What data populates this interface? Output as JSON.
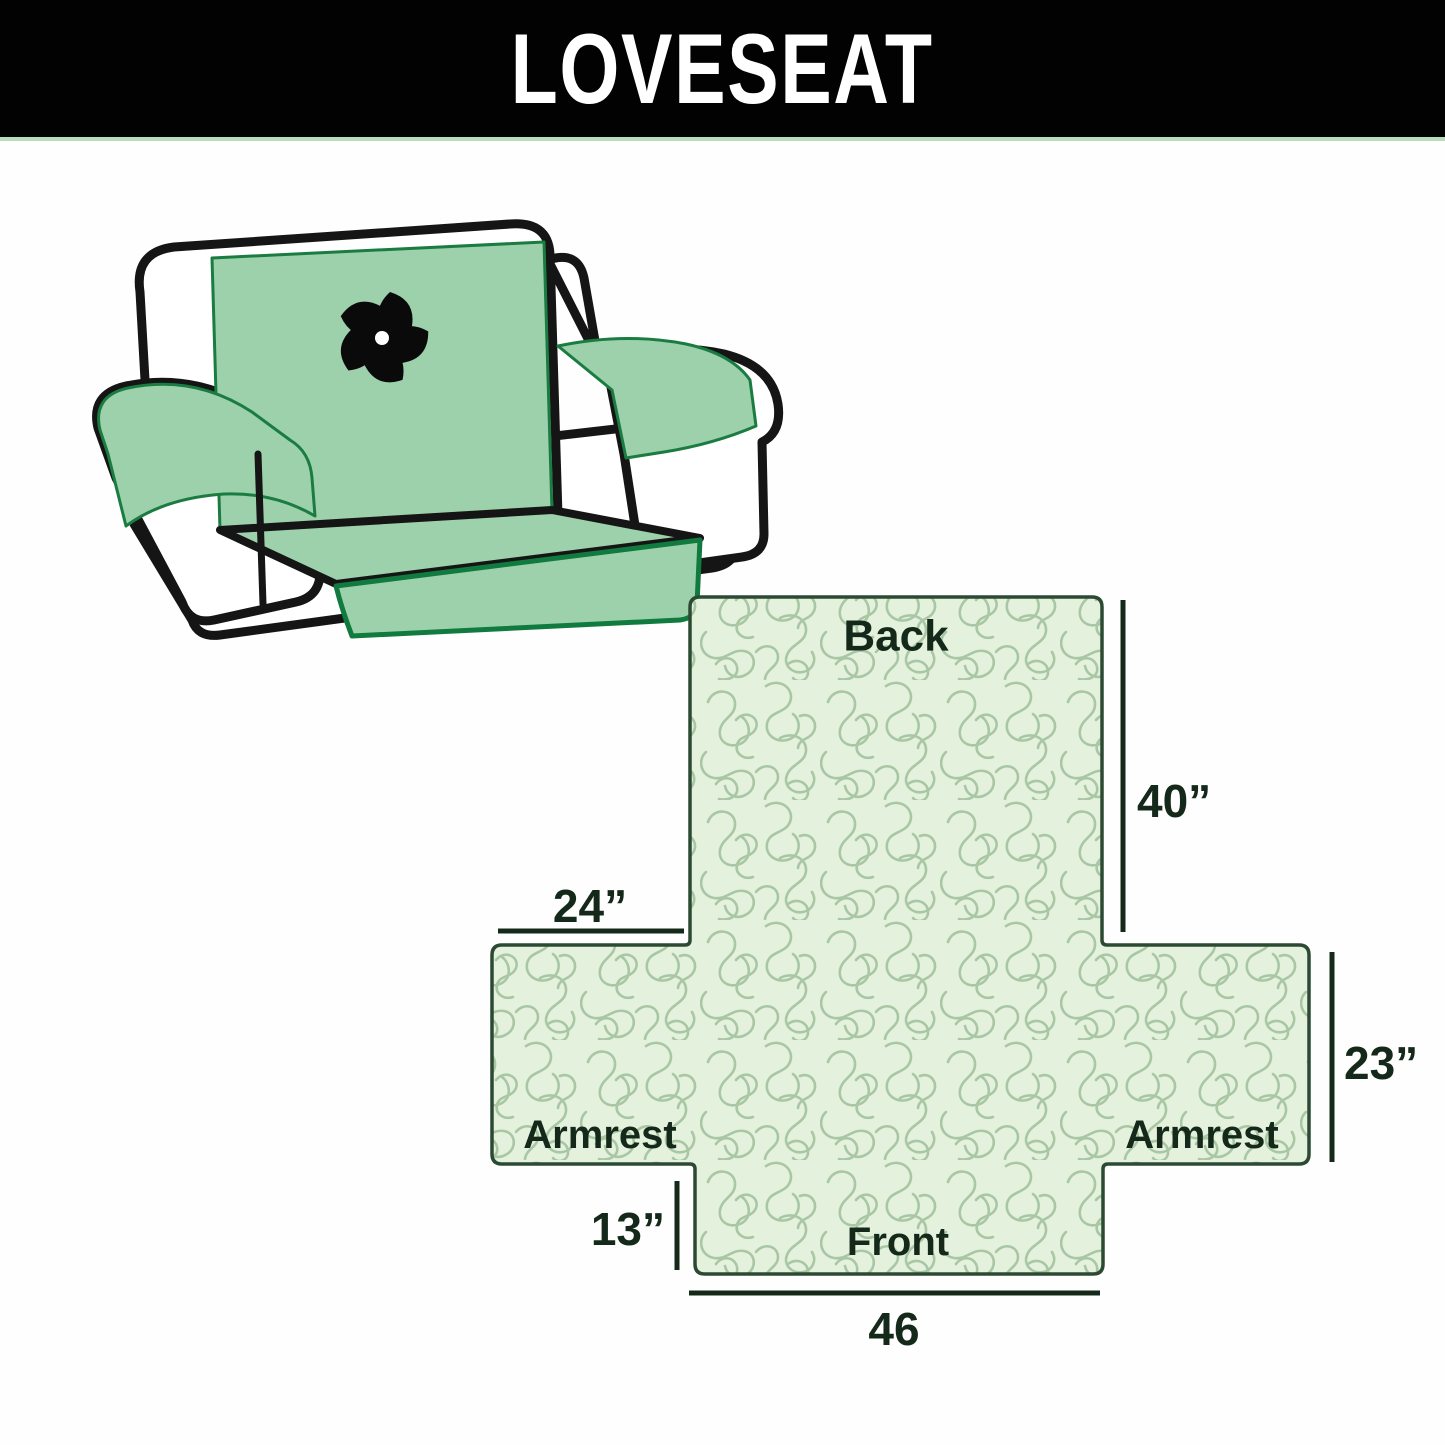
{
  "banner": {
    "title": "LOVESEAT",
    "background_color": "#020202",
    "text_color": "#ffffff"
  },
  "illustration": {
    "description": "line drawing of a loveseat sofa fitted with a green quilted cover",
    "logo_icon": "pinwheel",
    "cover_color": "#9cd1ac",
    "cover_edge_color": "#1b7c41",
    "outline_color": "#151515"
  },
  "diagram": {
    "center_label": "LOVESEAT",
    "labels": {
      "back": "Back",
      "front": "Front",
      "armrest_left": "Armrest",
      "armrest_right": "Armrest"
    },
    "dimensions": {
      "back_height": "40”",
      "armrest_left_width": "24”",
      "armrest_depth": "23”",
      "front_drop": "13”",
      "front_width": "46"
    },
    "colors": {
      "fill": "#e4f2dd",
      "pattern_lines": "#a9c7a4",
      "outline": "#2c4a33",
      "text": "#14291a"
    }
  }
}
